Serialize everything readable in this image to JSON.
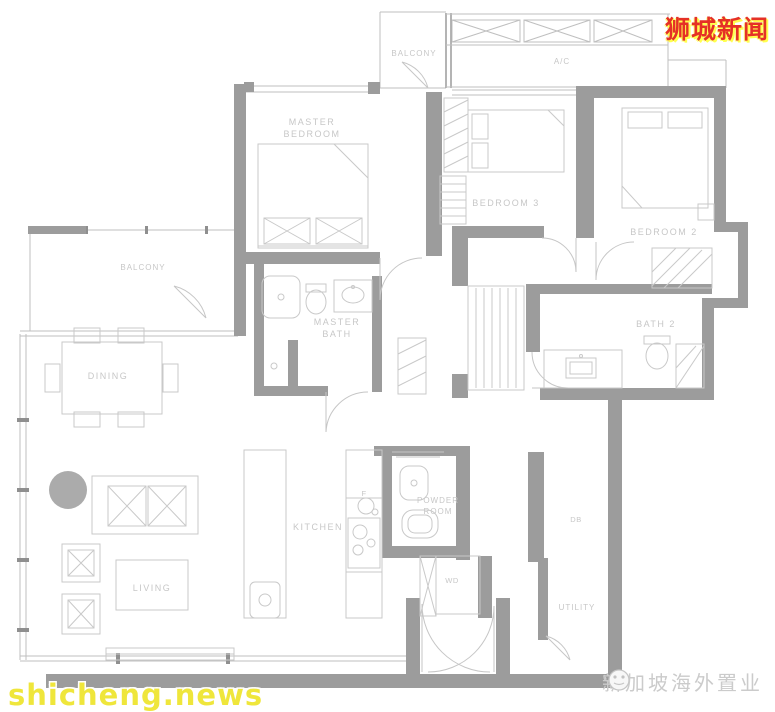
{
  "page": {
    "background": "#ffffff",
    "width": 775,
    "height": 712
  },
  "watermarks": {
    "site_cn": "狮城新闻",
    "site_en": "shicheng.news",
    "brand": "新加坡海外置业"
  },
  "labels": {
    "balcony_top": "BALCONY",
    "ac": "A/C",
    "master_bedroom_line1": "MASTER",
    "master_bedroom_line2": "BEDROOM",
    "bedroom3": "BEDROOM  3",
    "bedroom2": "BEDROOM  2",
    "balcony_left": "BALCONY",
    "master_bath_line1": "MASTER",
    "master_bath_line2": "BATH",
    "bath2": "BATH  2",
    "dining": "DINING",
    "kitchen": "KITCHEN",
    "fridge": "F",
    "living": "LIVING",
    "powder_line1": "POWDER",
    "powder_line2": "ROOM",
    "wd": "WD",
    "db": "DB",
    "utility": "UTILITY"
  },
  "colors": {
    "wall": "#9c9c9c",
    "thin_line": "#bfbfbf",
    "label": "#c7c7c7",
    "watermark_red": "#e53126",
    "watermark_yellow": "#efe63b",
    "brand_gray": "#cbcbcb",
    "accent_circle": "#ababab"
  }
}
